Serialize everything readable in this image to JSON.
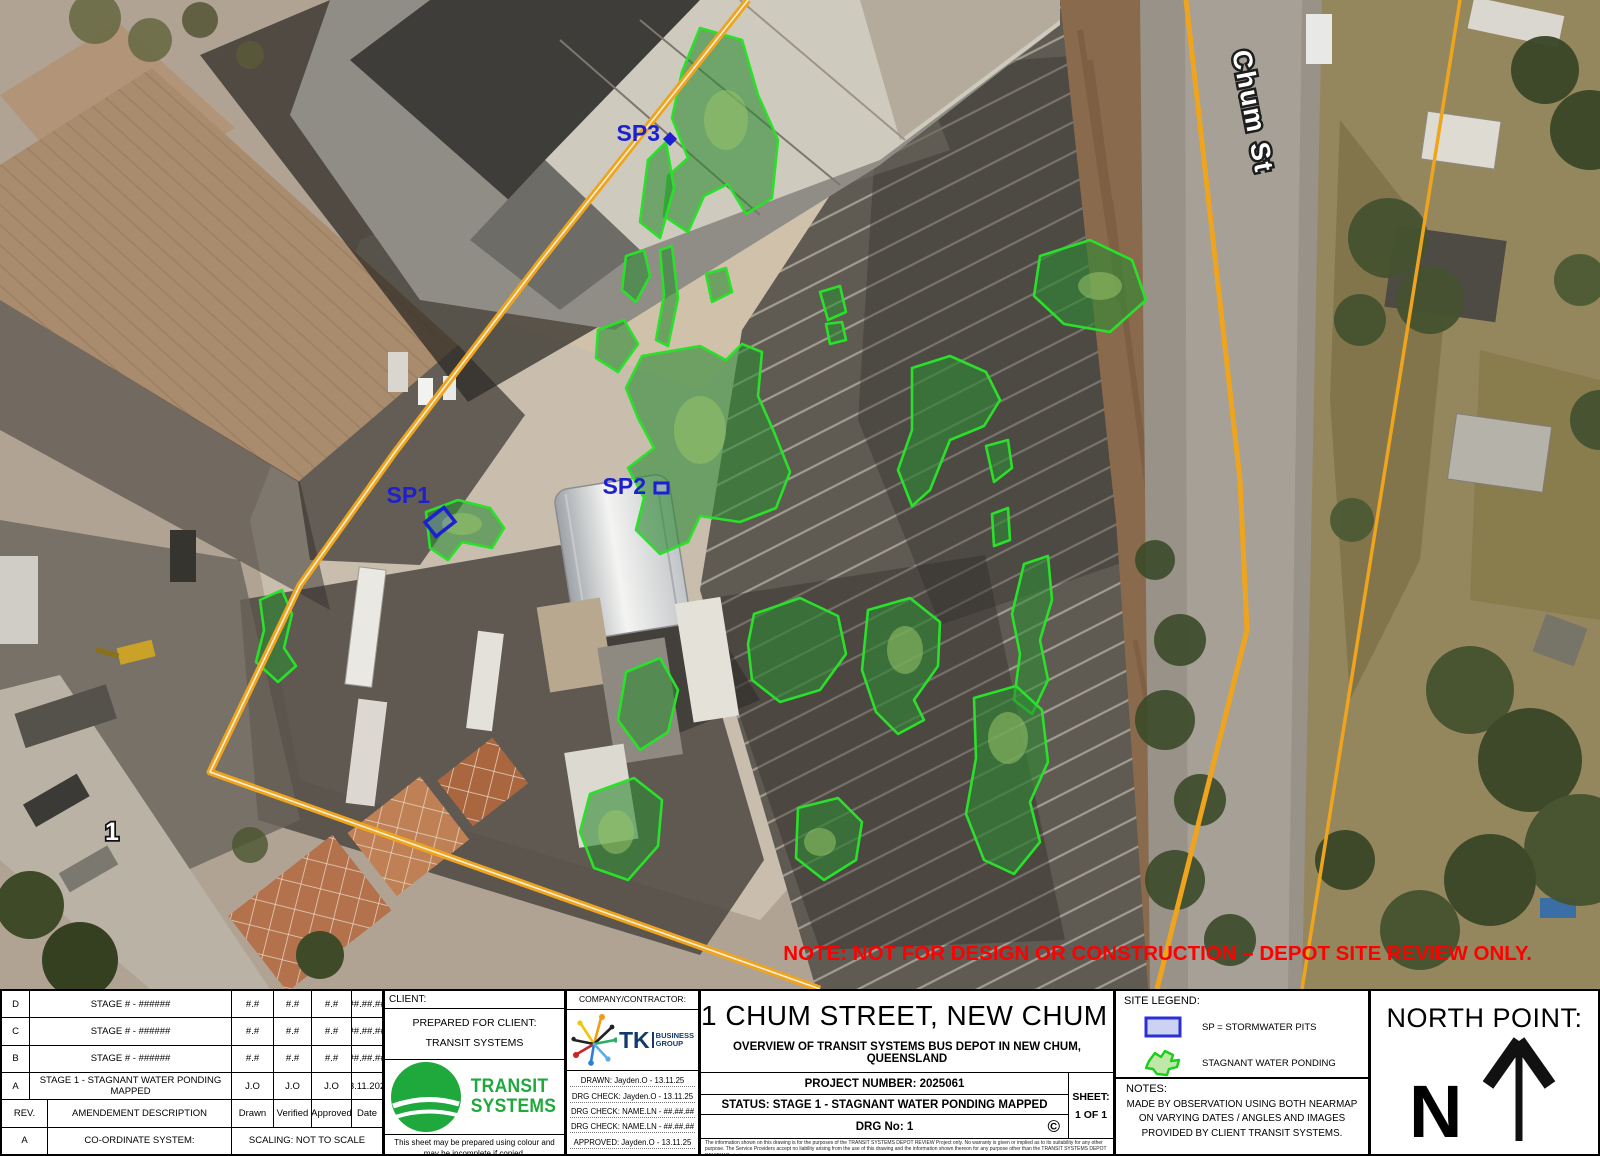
{
  "map": {
    "street_label": "Chum St",
    "address_marker": "1",
    "red_note": "NOTE: NOT FOR DESIGN OR CONSTRUCTION – DEPOT SITE REVIEW ONLY.",
    "markers": {
      "sp1": "SP1",
      "sp2": "SP2",
      "sp3": "SP3"
    },
    "colors": {
      "boundary_orange": "#EFA41E",
      "ponding_fill": "#2E8B33",
      "ponding_stroke": "#2BE02B",
      "marker_blue": "#1C20CE",
      "note_red": "#FF0000"
    }
  },
  "revision_table": {
    "header": {
      "rev": "REV.",
      "description": "AMENDEMENT DESCRIPTION",
      "drawn": "Drawn",
      "verified": "Verified",
      "approved": "Approved",
      "date": "Date"
    },
    "rows": [
      {
        "rev": "D",
        "description": "STAGE # - ######",
        "drawn": "#.#",
        "verified": "#.#",
        "approved": "#.#",
        "date": "##.##.##"
      },
      {
        "rev": "C",
        "description": "STAGE # - ######",
        "drawn": "#.#",
        "verified": "#.#",
        "approved": "#.#",
        "date": "##.##.##"
      },
      {
        "rev": "B",
        "description": "STAGE # - ######",
        "drawn": "#.#",
        "verified": "#.#",
        "approved": "#.#",
        "date": "##.##.##"
      },
      {
        "rev": "A",
        "description": "STAGE 1 - STAGNANT WATER PONDING MAPPED",
        "drawn": "J.O",
        "verified": "J.O",
        "approved": "J.O",
        "date": "13.11.2025"
      }
    ],
    "footer": {
      "rev": "A",
      "coordinate_system": "CO-ORDINATE SYSTEM:",
      "scaling": "SCALING: NOT TO SCALE"
    }
  },
  "client_block": {
    "header": "CLIENT:",
    "prepared_for": "PREPARED FOR CLIENT:",
    "client_name": "TRANSIT SYSTEMS",
    "logo_line1": "TRANSIT",
    "logo_line2": "SYSTEMS",
    "footnote": "This sheet may be prepared using colour and may be incomplete if copied."
  },
  "company_block": {
    "header": "COMPANY/CONTRACTOR:",
    "logo_tk": "TK",
    "logo_line1": "BUSINESS",
    "logo_line2": "GROUP",
    "fields": [
      {
        "text": "DRAWN: Jayden.O - 13.11.25"
      },
      {
        "text": "DRG CHECK: Jayden.O - 13.11.25"
      },
      {
        "text": "DRG CHECK: NAME.LN - ##.##.##"
      },
      {
        "text": "DRG CHECK: NAME.LN - ##.##.##"
      },
      {
        "text": "APPROVED: Jayden.O - 13.11.25"
      }
    ]
  },
  "title_block": {
    "title": "1 CHUM STREET, NEW CHUM 4303 QLD",
    "subtitle": "OVERVIEW OF TRANSIT SYSTEMS BUS DEPOT IN NEW CHUM, QUEENSLAND",
    "project_number": "PROJECT NUMBER: 2025061",
    "status": "STATUS: STAGE 1 - STAGNANT WATER PONDING MAPPED",
    "drg_no": "DRG No: 1",
    "copyright_symbol": "©",
    "sheet_label": "SHEET:",
    "sheet_value": "1 OF 1",
    "disclaimer": "The information shown on this drawing is for the purposes of the TRANSIT SYSTEMS DEPOT REVIEW Project only. No warranty is given or implied as to its suitability for any other purpose. The Service Providers accept no liability arising from the use of this drawing and the information shown thereon for any purpose other than the TRANSIT SYSTEMS DEPOT REVIEW Project."
  },
  "legend_block": {
    "header": "SITE LEGEND:",
    "items": [
      {
        "symbol": "stormwater-pit-swatch",
        "label": "SP = STORMWATER PITS"
      },
      {
        "symbol": "stagnant-ponding-swatch",
        "label": "STAGNANT WATER PONDING"
      }
    ],
    "notes_header": "NOTES:",
    "notes_lines": [
      "MADE BY OBSERVATION USING BOTH NEARMAP",
      "ON VARYING DATES / ANGLES AND IMAGES",
      "PROVIDED BY CLIENT TRANSIT SYSTEMS."
    ]
  },
  "north_block": {
    "header": "NORTH POINT:",
    "letter": "N"
  }
}
